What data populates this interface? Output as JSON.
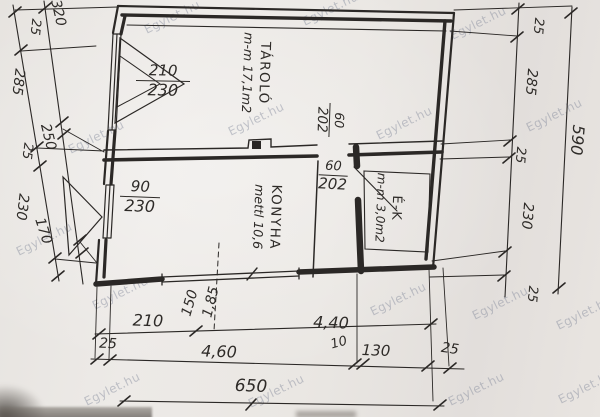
{
  "watermark": {
    "text": "Egylet.hu"
  },
  "rooms": {
    "tarolo": {
      "name": "TÁROLÓ",
      "detail": "m-m 17,1m2"
    },
    "konyha": {
      "name": "KONYHA",
      "detail": "mettl 10,6"
    },
    "ek": {
      "name": "É-K",
      "detail": "m-m 3,0m2"
    }
  },
  "openings": {
    "window1": {
      "width": "210",
      "height": "230"
    },
    "window2": {
      "width": "90",
      "height": "230"
    },
    "door1": {
      "width": "60",
      "height": "202"
    },
    "door2": {
      "width": "60",
      "height": "202"
    }
  },
  "dims": {
    "left_outer": [
      "25",
      "285",
      "25",
      "230"
    ],
    "left_inner": [
      "320",
      "250",
      "170"
    ],
    "right": [
      "25",
      "285",
      "25",
      "230",
      "25"
    ],
    "right_total": "590",
    "bottom_row1": [
      "210",
      "4,40"
    ],
    "window_bottom": [
      "150",
      "1,85"
    ],
    "bottom_row2": [
      "25",
      "4,60",
      "10",
      "130",
      "25"
    ],
    "bottom_total": "650"
  },
  "colors": {
    "ink": "#2b2826",
    "paper": "#eae7e3",
    "watermark_gray": "#8a90a0"
  }
}
